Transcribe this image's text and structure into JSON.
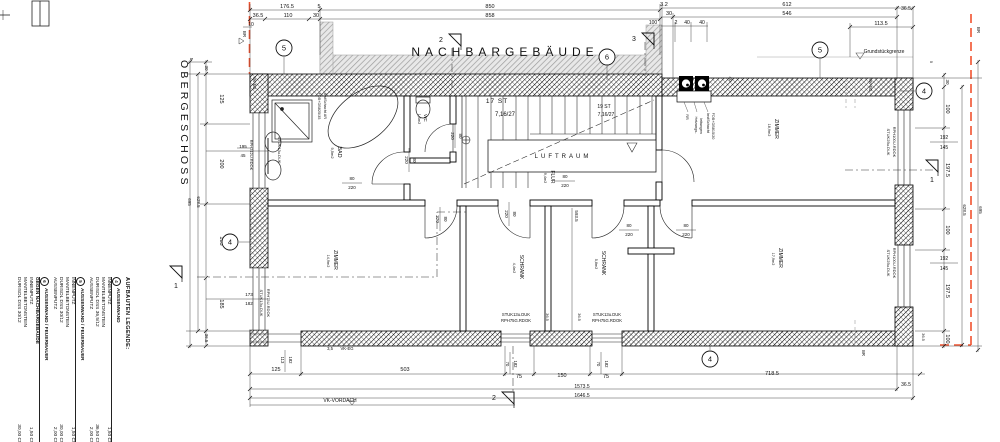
{
  "drawing": {
    "floor_title": "OBERGESCHOSS",
    "neighbor_label": "NACHBARGEBÄUDE",
    "property_label": "Grundstückgrenze"
  },
  "colors": {
    "wall_hatch": "#000000",
    "neighbor_gray": "#9c9c9c",
    "boundary_red": "#f2522e",
    "dim_line": "#333333",
    "text": "#111111"
  },
  "legend": {
    "title": "AUFBAUTEN LEGENDE:",
    "items": [
      {
        "num": "4",
        "title": "AUSSENWAND",
        "rows": [
          [
            "INNENPUTZ",
            "1,50 CM"
          ],
          [
            "MANTELBETONSTEIN",
            ""
          ],
          [
            "DURISOL DSS 36,5/12",
            "36,50 CM"
          ],
          [
            "AUSSENPUTZ",
            "2,00 CM"
          ]
        ]
      },
      {
        "num": "5",
        "title": "AUSSENWAND / FEUERMAUER",
        "rows": [
          [
            "INNENPUTZ",
            "1,50 CM"
          ],
          [
            "MANTELBETONSTEIN",
            ""
          ],
          [
            "DURISOL DSS 30/12",
            "30,00 CM"
          ],
          [
            "AUSSENPUTZ",
            "2,00 CM"
          ]
        ]
      },
      {
        "num": "6",
        "title": "AUSSENWAND / FEUERMAUER",
        "title2": "GEGEN NACHBARGEBÄUDE",
        "rows": [
          [
            "INNENPUTZ",
            "1,50 CM"
          ],
          [
            "MANTELBETONSTEIN",
            ""
          ],
          [
            "DURISOL DSS 30/12",
            "30,00 CM"
          ]
        ]
      }
    ]
  },
  "circles": [
    {
      "n": "5",
      "x": 284,
      "y": 48
    },
    {
      "n": "6",
      "x": 607,
      "y": 57
    },
    {
      "n": "5",
      "x": 820,
      "y": 50
    },
    {
      "n": "4",
      "x": 924,
      "y": 91
    },
    {
      "n": "4",
      "x": 230,
      "y": 242
    },
    {
      "n": "4",
      "x": 710,
      "y": 359
    }
  ],
  "flags": [
    {
      "n": "2",
      "x": 443,
      "y": 40
    },
    {
      "n": "3",
      "x": 636,
      "y": 39
    },
    {
      "n": "2",
      "x": 496,
      "y": 398
    },
    {
      "n": "1",
      "x": 176,
      "y": 272,
      "v": true
    },
    {
      "n": "1",
      "x": 932,
      "y": 166,
      "v": true
    }
  ],
  "labels": [
    {
      "t": "OBERGESCHOSS",
      "x": 181,
      "y": 60,
      "r": 1,
      "s": 10.5,
      "ls": 3.2,
      "a": "start",
      "n": "floor-title"
    },
    {
      "t": "NACHBARGEBÄUDE",
      "x": 505,
      "y": 56,
      "s": 12,
      "c": "#a8a8a8",
      "ls": 5,
      "n": "neighbor-building-label"
    },
    {
      "t": "Grundstückgrenze",
      "x": 884,
      "y": 53,
      "s": 5,
      "n": "property-line-label"
    },
    {
      "t": "176.5",
      "x": 287,
      "y": 8
    },
    {
      "t": "5",
      "x": 319,
      "y": 8
    },
    {
      "t": "850",
      "x": 490,
      "y": 8
    },
    {
      "t": "858",
      "x": 490,
      "y": 17
    },
    {
      "t": "36.5",
      "x": 258,
      "y": 17
    },
    {
      "t": "110",
      "x": 288,
      "y": 17
    },
    {
      "t": "30",
      "x": 316,
      "y": 17
    },
    {
      "t": "10",
      "x": 251,
      "y": 26,
      "s": 5
    },
    {
      "t": "3.2",
      "x": 664,
      "y": 6
    },
    {
      "t": "30",
      "x": 669,
      "y": 15
    },
    {
      "t": "612",
      "x": 787,
      "y": 6
    },
    {
      "t": "546",
      "x": 787,
      "y": 15
    },
    {
      "t": "36.5",
      "x": 906,
      "y": 10,
      "s": 5
    },
    {
      "t": "113.5",
      "x": 881,
      "y": 25
    },
    {
      "t": "100",
      "x": 653,
      "y": 24,
      "s": 5
    },
    {
      "t": "2",
      "x": 676,
      "y": 24,
      "s": 5
    },
    {
      "t": "40",
      "x": 687,
      "y": 24,
      "s": 5
    },
    {
      "t": "40",
      "x": 702,
      "y": 24,
      "s": 5
    },
    {
      "t": "BR",
      "x": 243,
      "y": 34,
      "r": 1,
      "s": 4.5
    },
    {
      "t": "BR",
      "x": 977,
      "y": 30,
      "r": 1,
      "s": 4.5
    },
    {
      "t": "5",
      "x": 190,
      "y": 59,
      "r": 1,
      "s": 4.5
    },
    {
      "t": "30",
      "x": 205,
      "y": 68,
      "r": 1,
      "s": 4.5
    },
    {
      "t": "125",
      "x": 220,
      "y": 99,
      "r": 1
    },
    {
      "t": "200",
      "x": 220,
      "y": 164,
      "r": 1
    },
    {
      "t": "185",
      "x": 220,
      "y": 241,
      "r": 1
    },
    {
      "t": "185",
      "x": 220,
      "y": 304,
      "r": 1
    },
    {
      "t": "36.5",
      "x": 205,
      "y": 338,
      "r": 1,
      "s": 4.5
    },
    {
      "t": "628.5",
      "x": 197,
      "y": 202,
      "r": 1,
      "s": 4.5
    },
    {
      "t": "695",
      "x": 188,
      "y": 202,
      "r": 1,
      "s": 4.5
    },
    {
      "t": "195",
      "x": 243,
      "y": 148,
      "s": 4.5
    },
    {
      "t": "45",
      "x": 243,
      "y": 157,
      "s": 4.5
    },
    {
      "t": "173",
      "x": 249,
      "y": 296,
      "s": 4.5
    },
    {
      "t": "182",
      "x": 249,
      "y": 305,
      "s": 4.5
    },
    {
      "t": "VK-EG",
      "x": 253,
      "y": 83,
      "r": 1,
      "s": 4.2
    },
    {
      "t": "RPH212U.RDOK",
      "x": 250,
      "y": 155,
      "r": 1,
      "s": 4
    },
    {
      "t": "STUK13u.DUK",
      "x": 278,
      "y": 150,
      "r": 1,
      "s": 4
    },
    {
      "t": "STUK13u.DUK",
      "x": 260,
      "y": 303,
      "r": 1,
      "s": 4
    },
    {
      "t": "RPH75U.RDOK",
      "x": 267,
      "y": 303,
      "r": 1,
      "s": 4
    },
    {
      "t": "BAD",
      "x": 338,
      "y": 152,
      "r": 1,
      "s": 5.5,
      "n": "room-label"
    },
    {
      "t": "9,5m2",
      "x": 331,
      "y": 153,
      "r": 1,
      "s": 4
    },
    {
      "t": "FDB+DB825/35",
      "x": 318,
      "y": 106,
      "r": 1,
      "s": 3.8
    },
    {
      "t": "InstSchacht AR",
      "x": 324,
      "y": 106,
      "r": 1,
      "s": 3.8
    },
    {
      "t": "WC",
      "x": 424,
      "y": 118,
      "r": 1,
      "s": 4.5,
      "n": "room-label"
    },
    {
      "t": "1,4m2",
      "x": 418,
      "y": 119,
      "r": 1,
      "s": 3.8
    },
    {
      "t": "17 ST",
      "x": 497,
      "y": 103,
      "s": 6.5,
      "ls": 1
    },
    {
      "t": "7,16/27",
      "x": 505,
      "y": 116,
      "s": 6
    },
    {
      "t": "19 ST",
      "x": 604,
      "y": 108,
      "s": 5
    },
    {
      "t": "7,16/27",
      "x": 606,
      "y": 116,
      "s": 5
    },
    {
      "t": "LUFTRAUM",
      "x": 563,
      "y": 158,
      "s": 6,
      "ls": 3,
      "n": "room-label"
    },
    {
      "t": "FLUR",
      "x": 551,
      "y": 177,
      "r": 1,
      "s": 5,
      "n": "room-label"
    },
    {
      "t": "9,4m2",
      "x": 544,
      "y": 178,
      "r": 1,
      "s": 3.8
    },
    {
      "t": "ZIMMER",
      "x": 775,
      "y": 129,
      "r": 1,
      "s": 5,
      "n": "room-label"
    },
    {
      "t": "18,9m2",
      "x": 768,
      "y": 130,
      "r": 1,
      "s": 3.8
    },
    {
      "t": "ZIMMER",
      "x": 779,
      "y": 258,
      "r": 1,
      "s": 5,
      "n": "room-label"
    },
    {
      "t": "17,9m2",
      "x": 772,
      "y": 259,
      "r": 1,
      "s": 3.8
    },
    {
      "t": "ZIMMER",
      "x": 334,
      "y": 260,
      "r": 1,
      "s": 5,
      "n": "room-label"
    },
    {
      "t": "14,9m2",
      "x": 327,
      "y": 261,
      "r": 1,
      "s": 3.8
    },
    {
      "t": "SCHRANK",
      "x": 520,
      "y": 267,
      "r": 1,
      "s": 5,
      "n": "room-label"
    },
    {
      "t": "4,4m2",
      "x": 513,
      "y": 268,
      "r": 1,
      "s": 3.8
    },
    {
      "t": "SCHRANK",
      "x": 602,
      "y": 263,
      "r": 1,
      "s": 5,
      "n": "room-label"
    },
    {
      "t": "5,8m2",
      "x": 595,
      "y": 264,
      "r": 1,
      "s": 3.8
    },
    {
      "t": "RR",
      "x": 686,
      "y": 117,
      "r": 1,
      "s": 3.8
    },
    {
      "t": "Heizungs-",
      "x": 695,
      "y": 125,
      "r": 1,
      "s": 3.8
    },
    {
      "t": "leitungen",
      "x": 700,
      "y": 126,
      "r": 1,
      "s": 3.8
    },
    {
      "t": "InstSchacht",
      "x": 707,
      "y": 123,
      "r": 1,
      "s": 3.8
    },
    {
      "t": "FDB+DB815/20",
      "x": 712,
      "y": 126,
      "r": 1,
      "s": 3.8
    },
    {
      "t": "40",
      "x": 729,
      "y": 79,
      "r": 1,
      "s": 4.5
    },
    {
      "t": "VK-EG",
      "x": 869,
      "y": 85,
      "r": 1,
      "s": 4.2
    },
    {
      "t": "RPH100U.RDOK",
      "x": 893,
      "y": 142,
      "r": 1,
      "s": 4
    },
    {
      "t": "STUK25u.DUK",
      "x": 887,
      "y": 142,
      "r": 1,
      "s": 4
    },
    {
      "t": "RPH100U.RDOK",
      "x": 893,
      "y": 263,
      "r": 1,
      "s": 4
    },
    {
      "t": "STUK25u.DUK",
      "x": 887,
      "y": 263,
      "r": 1,
      "s": 4
    },
    {
      "t": "192",
      "x": 944,
      "y": 139,
      "s": 5
    },
    {
      "t": "145",
      "x": 944,
      "y": 149,
      "s": 5
    },
    {
      "t": "192",
      "x": 944,
      "y": 260,
      "s": 5
    },
    {
      "t": "145",
      "x": 944,
      "y": 270,
      "s": 5
    },
    {
      "t": "STUK13u.DUK",
      "x": 516,
      "y": 316,
      "s": 4.2
    },
    {
      "t": "RPH75G.RDOK",
      "x": 516,
      "y": 322,
      "s": 4.2
    },
    {
      "t": "STUK13u.DUK",
      "x": 607,
      "y": 316,
      "s": 4.2
    },
    {
      "t": "RPH75G.RDOK",
      "x": 607,
      "y": 322,
      "s": 4.2
    },
    {
      "t": "36.5",
      "x": 546,
      "y": 317,
      "r": 1,
      "s": 4
    },
    {
      "t": "36.5",
      "x": 578,
      "y": 317,
      "r": 1,
      "s": 4
    },
    {
      "t": "593.5",
      "x": 575,
      "y": 216,
      "r": 1,
      "s": 4.5
    },
    {
      "t": "3,5",
      "x": 330,
      "y": 350,
      "s": 4.2
    },
    {
      "t": "VK-EG",
      "x": 347,
      "y": 350,
      "s": 4.2
    },
    {
      "t": "VK-VORDACH",
      "x": 340,
      "y": 402,
      "s": 5
    },
    {
      "t": "BR",
      "x": 862,
      "y": 353,
      "r": 1,
      "s": 4.2
    },
    {
      "t": "80",
      "x": 352,
      "y": 180,
      "s": 4.5
    },
    {
      "t": "220",
      "x": 352,
      "y": 189,
      "s": 4.5
    },
    {
      "t": "80",
      "x": 413,
      "y": 160,
      "r": 1,
      "s": 4.5
    },
    {
      "t": "220",
      "x": 405,
      "y": 160,
      "r": 1,
      "s": 4.5
    },
    {
      "t": "80",
      "x": 459,
      "y": 136,
      "r": 1,
      "s": 4.5
    },
    {
      "t": "220",
      "x": 451,
      "y": 136,
      "r": 1,
      "s": 4.5
    },
    {
      "t": "80",
      "x": 565,
      "y": 178,
      "s": 4.5
    },
    {
      "t": "220",
      "x": 565,
      "y": 187,
      "s": 4.5
    },
    {
      "t": "80",
      "x": 444,
      "y": 219,
      "r": 1,
      "s": 4.5
    },
    {
      "t": "220",
      "x": 436,
      "y": 219,
      "r": 1,
      "s": 4.5
    },
    {
      "t": "80",
      "x": 513,
      "y": 214,
      "r": 1,
      "s": 4.5
    },
    {
      "t": "220",
      "x": 505,
      "y": 214,
      "r": 1,
      "s": 4.5
    },
    {
      "t": "80",
      "x": 629,
      "y": 227,
      "s": 4.5
    },
    {
      "t": "220",
      "x": 629,
      "y": 236,
      "s": 4.5
    },
    {
      "t": "80",
      "x": 686,
      "y": 227,
      "s": 4.5
    },
    {
      "t": "220",
      "x": 686,
      "y": 236,
      "s": 4.5
    },
    {
      "t": "125",
      "x": 276,
      "y": 371
    },
    {
      "t": "503",
      "x": 405,
      "y": 371
    },
    {
      "t": "75",
      "x": 519,
      "y": 378
    },
    {
      "t": "150",
      "x": 562,
      "y": 377
    },
    {
      "t": "75",
      "x": 606,
      "y": 378
    },
    {
      "t": "718.5",
      "x": 772,
      "y": 375
    },
    {
      "t": "36.5",
      "x": 906,
      "y": 386,
      "s": 5
    },
    {
      "t": "1573.5",
      "x": 582,
      "y": 388,
      "s": 5
    },
    {
      "t": "1646.5",
      "x": 582,
      "y": 397,
      "s": 5
    },
    {
      "t": "70",
      "x": 506,
      "y": 364,
      "r": 1,
      "s": 4.2
    },
    {
      "t": "182",
      "x": 514,
      "y": 364,
      "r": 1,
      "s": 4.2
    },
    {
      "t": "70",
      "x": 597,
      "y": 364,
      "r": 1,
      "s": 4.2
    },
    {
      "t": "182",
      "x": 605,
      "y": 364,
      "r": 1,
      "s": 4.2
    },
    {
      "t": "113",
      "x": 281,
      "y": 360,
      "r": 1,
      "s": 4.2
    },
    {
      "t": "182",
      "x": 289,
      "y": 360,
      "r": 1,
      "s": 4.2
    },
    {
      "t": "5",
      "x": 930,
      "y": 62,
      "r": 1,
      "s": 4
    },
    {
      "t": "30",
      "x": 946,
      "y": 82,
      "r": 1,
      "s": 4.5
    },
    {
      "t": "100",
      "x": 946,
      "y": 109,
      "r": 1
    },
    {
      "t": "197.5",
      "x": 946,
      "y": 170,
      "r": 1
    },
    {
      "t": "100",
      "x": 946,
      "y": 230,
      "r": 1
    },
    {
      "t": "197.5",
      "x": 946,
      "y": 291,
      "r": 1
    },
    {
      "t": "100",
      "x": 946,
      "y": 339,
      "r": 1
    },
    {
      "t": "628.5",
      "x": 963,
      "y": 210,
      "r": 1,
      "s": 4.5
    },
    {
      "t": "695",
      "x": 979,
      "y": 210,
      "r": 1,
      "s": 4.5
    },
    {
      "t": "36.5",
      "x": 922,
      "y": 337,
      "r": 1,
      "s": 4
    }
  ]
}
